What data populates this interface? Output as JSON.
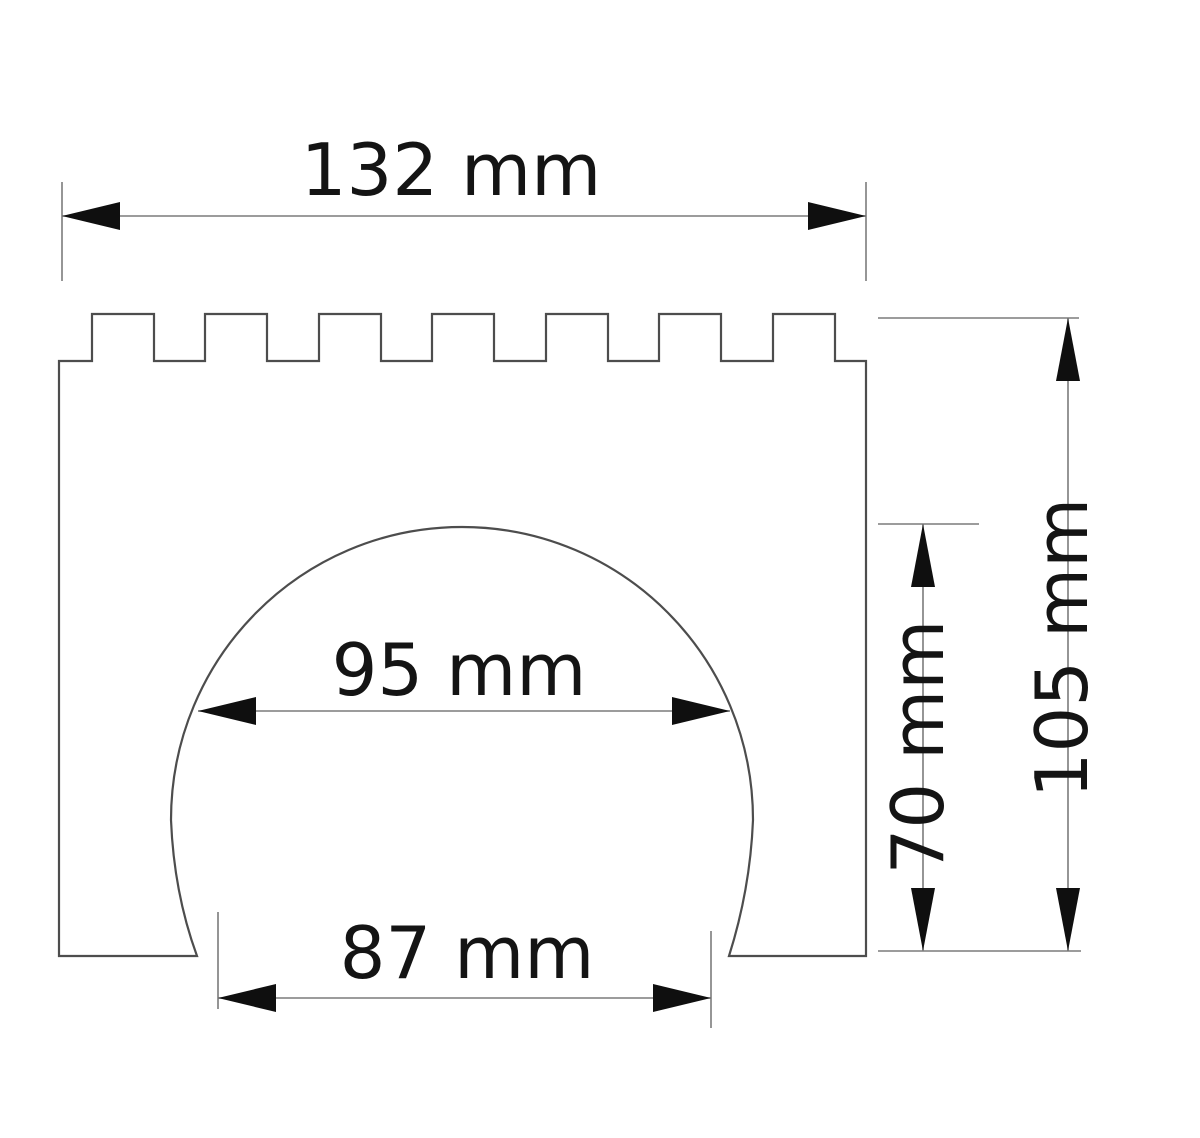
{
  "page": {
    "title": "Technical drawing of crenellated arch block",
    "background": "#ffffff"
  },
  "drawing": {
    "units": "mm",
    "style": {
      "outline_color": "#4d4d4d",
      "dimension_line_color": "#7b7b7b",
      "arrow_color": "#0f0f0f",
      "text_color": "#141414"
    },
    "part": {
      "name": "crenellated-arch-block-profile",
      "teeth_count": 7
    },
    "dimensions": {
      "overall_width": {
        "label": "132 mm",
        "value": 132,
        "orientation": "horizontal",
        "location": "top"
      },
      "arch_width": {
        "label": "95 mm",
        "value": 95,
        "orientation": "horizontal",
        "location": "arch-middle"
      },
      "base_opening_width": {
        "label": "87 mm",
        "value": 87,
        "orientation": "horizontal",
        "location": "bottom"
      },
      "arch_height": {
        "label": "70 mm",
        "value": 70,
        "orientation": "vertical",
        "location": "right-inner"
      },
      "overall_height": {
        "label": "105 mm",
        "value": 105,
        "orientation": "vertical",
        "location": "right-outer"
      }
    }
  }
}
